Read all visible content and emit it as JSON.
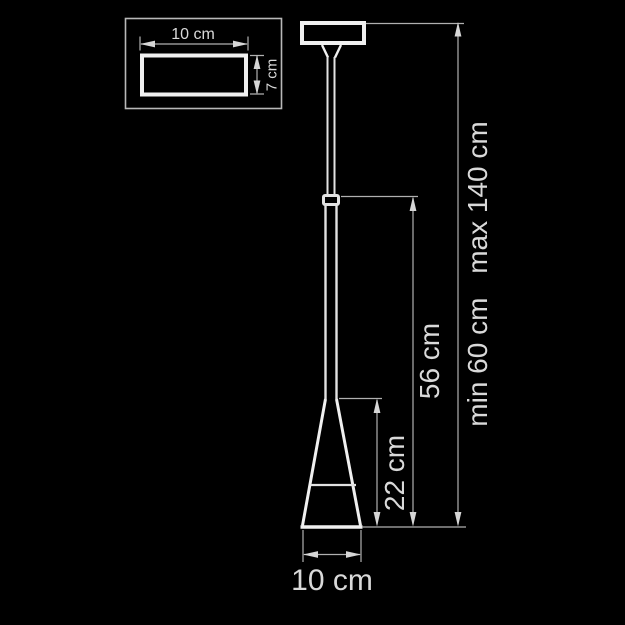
{
  "drawing": {
    "description": "Technical dimension drawing of a cone pendant lamp",
    "background_color": "#000000",
    "object_line_color": "#f0f0f0",
    "dimension_line_color": "#b0b0b0",
    "text_color": "#d9d9d9"
  },
  "inset": {
    "width_label": "10 cm",
    "depth_label": "7 cm"
  },
  "dims": {
    "shade_width": "10 cm",
    "shade_height": "22 cm",
    "fixture_height": "56 cm",
    "suspension_min": "min 60 cm",
    "suspension_max": "max 140 cm"
  }
}
